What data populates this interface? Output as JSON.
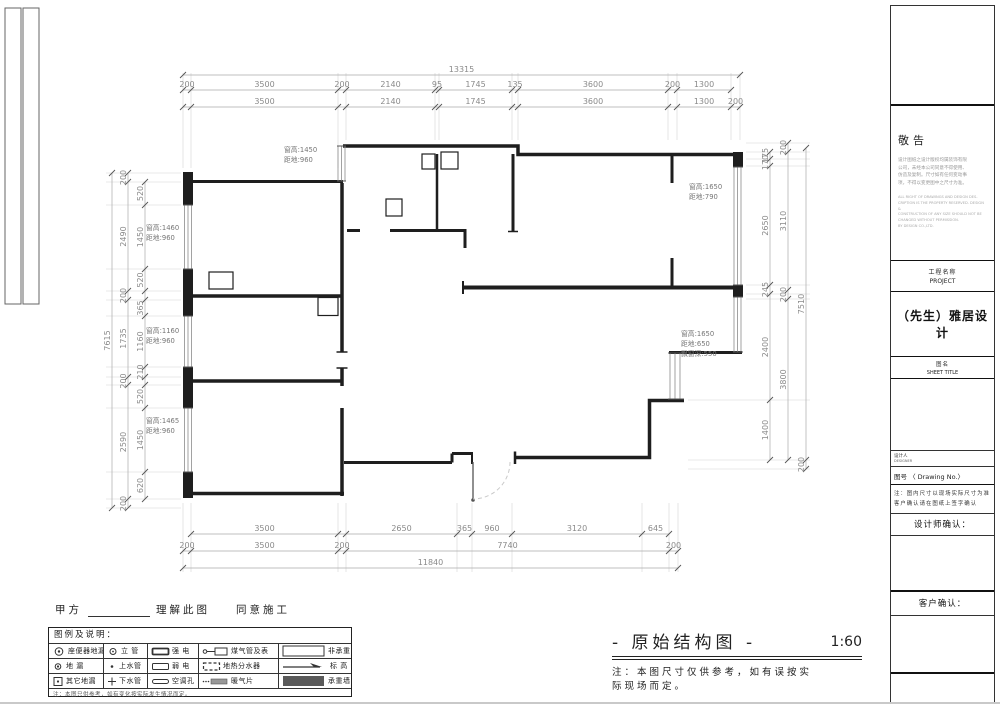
{
  "sheet": {
    "party_a": "甲方",
    "understand": "理解此图",
    "agree": "同意施工",
    "main_title": "- 原始结构图 -",
    "scale": "1:60",
    "main_note_lines": [
      "注：本图尺寸仅供参考，如有误按实",
      "际现场而定。"
    ]
  },
  "dims": {
    "top_total": "13315",
    "top_row1": [
      "200",
      "3500",
      "200",
      "2140",
      "95",
      "1745",
      "135",
      "3600",
      "200",
      "1300"
    ],
    "top_row2": [
      "3500",
      "2140",
      "1745",
      "3600",
      "1300",
      "200"
    ],
    "left_total": "7615",
    "left_mid": [
      "200",
      "2490",
      "200",
      "1735",
      "200",
      "2590",
      "200"
    ],
    "left_inner": [
      "520",
      "1450",
      "520",
      "365",
      "1160",
      "210",
      "520",
      "1450",
      "620"
    ],
    "right_inner": [
      "175",
      "170",
      "2650",
      "245",
      "2400",
      "1400"
    ],
    "right_mid": [
      "200",
      "3110",
      "200",
      "3800"
    ],
    "right_outer": [
      "7510",
      "200"
    ],
    "bottom_row1": [
      "3500",
      "2650",
      "365",
      "960",
      "3120",
      "645"
    ],
    "bottom_row2": [
      "200",
      "3500",
      "200",
      "7740",
      "200"
    ],
    "bottom_total": "11840"
  },
  "window_labels": {
    "w1": [
      "窗高:1450",
      "距地:960"
    ],
    "w2": [
      "窗高:1460",
      "距地:960"
    ],
    "w3": [
      "窗高:1160",
      "距地:960"
    ],
    "w4": [
      "窗高:1465",
      "距地:960"
    ],
    "w5": [
      "窗高:1650",
      "距地:790"
    ],
    "w6": [
      "窗高:1650",
      "距地:650",
      "飘窗深:550"
    ]
  },
  "legend": {
    "header": "图例及说明：",
    "note": "注：本图只供参考，如有变化按实际发生情况而定。",
    "rows": [
      [
        {
          "sym": "wc-drain",
          "label": "座便器地漏"
        },
        {
          "sym": "pipe-riser",
          "label": "立 管"
        },
        {
          "sym": "strong-elec",
          "label": "强 电"
        },
        {
          "sym": "gas-meter",
          "label": "煤气管及表"
        },
        {
          "sym": "nonbearing-wall",
          "label": "非承重墙"
        }
      ],
      [
        {
          "sym": "floor-drain",
          "label": "地 漏"
        },
        {
          "sym": "water-supply",
          "label": "上水管"
        },
        {
          "sym": "weak-elec",
          "label": "弱 电"
        },
        {
          "sym": "floor-heating-manifold",
          "label": "地热分水器"
        },
        {
          "sym": "elevation",
          "label": "标 高"
        }
      ],
      [
        {
          "sym": "other-drain",
          "label": "其它地漏"
        },
        {
          "sym": "water-drain",
          "label": "下水管"
        },
        {
          "sym": "ac-hole",
          "label": "空调孔"
        },
        {
          "sym": "radiator",
          "label": "暖气片"
        },
        {
          "sym": "bearing-wall",
          "label": "承重墙"
        }
      ]
    ]
  },
  "title_block": {
    "notice_title": "敬告",
    "notice_cn": [
      "设计图纸之设计版权均属装饰有限",
      "公司，未经本公司同意不得使用、",
      "仿造及复制。尺寸如有任何变动事",
      "项，不得以变更图中之尺寸为准。"
    ],
    "notice_en": [
      "ALL RIGHT OF DRAWINGS AND DESIGN DES-",
      "CRIPTION IS THE PROPERTY RESERVED. DESIGN &",
      "CONSTRUCTION OF ANY SIZE SHOULD NOT BE",
      "CHANGED WITHOUT PERMISSION.",
      "BY DESIGN CO.,LTD."
    ],
    "project_label_cn": "工程名称",
    "project_label_en": "PROJECT",
    "project_name": "（先生）雅居设计",
    "sheet_label_cn": "图名",
    "sheet_label_en": "SHEET TITLE",
    "designer_label": "设计人",
    "designer_label2": "DESIGNER",
    "drawing_no_label": "图号 〈 Drawing No.〉",
    "note_lines": [
      "注：图内尺寸以现场实际尺寸为准",
      "客户确认请在图纸上签字确认"
    ],
    "designer_confirm": "设计师确认：",
    "client_confirm": "客户确认："
  }
}
